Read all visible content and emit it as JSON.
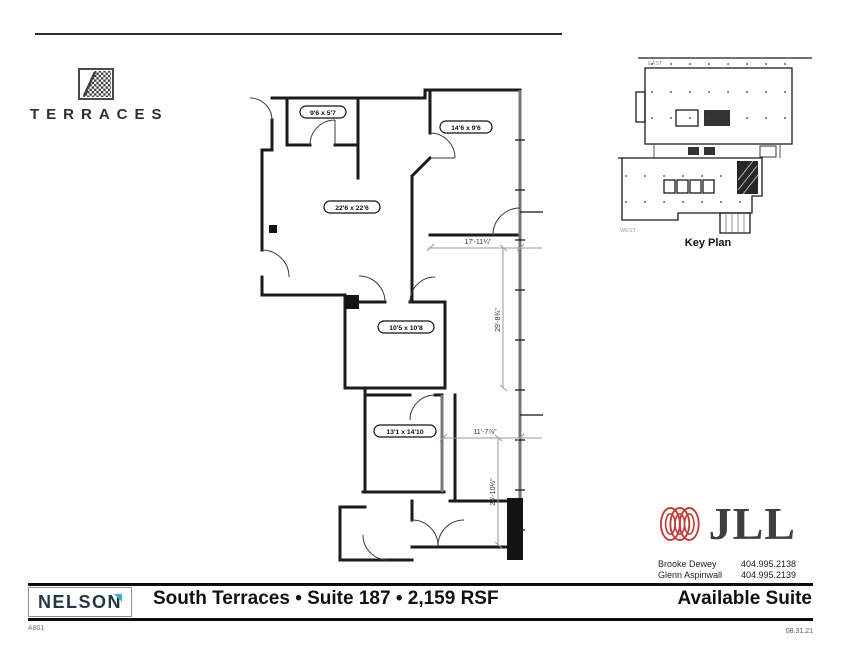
{
  "page": {
    "sheet_number": "A801",
    "date": "08.31.21"
  },
  "branding": {
    "terraces": {
      "name": "TERRACES"
    },
    "nelson": {
      "name_main": "NELSO",
      "name_accent": "N"
    },
    "jll": {
      "name": "JLL"
    }
  },
  "title_bar": {
    "title": "South Terraces • Suite 187 • 2,159 RSF",
    "availability": "Available Suite"
  },
  "contacts": [
    {
      "name": "Brooke Dewey",
      "phone": "404.995.2138"
    },
    {
      "name": "Glenn Aspinwall",
      "phone": "404.995.2139"
    }
  ],
  "key_plan": {
    "label": "Key Plan",
    "east_label": "EAST",
    "west_label": "WEST"
  },
  "floor_plan": {
    "rooms": [
      {
        "label": "9'6 x 5'7"
      },
      {
        "label": "14'6 x 9'6"
      },
      {
        "label": "22'6 x 22'6"
      },
      {
        "label": "10'5 x 10'8"
      },
      {
        "label": "13'1 x 14'10"
      }
    ],
    "dimensions": [
      {
        "label": "17'-11¼\""
      },
      {
        "label": "29'-8¾\""
      },
      {
        "label": "11'-7⅞\""
      },
      {
        "label": "26'-10½\""
      }
    ]
  },
  "colors": {
    "jll_red": "#c13b38",
    "nelson_navy": "#253746",
    "nelson_teal": "#3eb1c8",
    "wall": "#1b1b1b"
  }
}
